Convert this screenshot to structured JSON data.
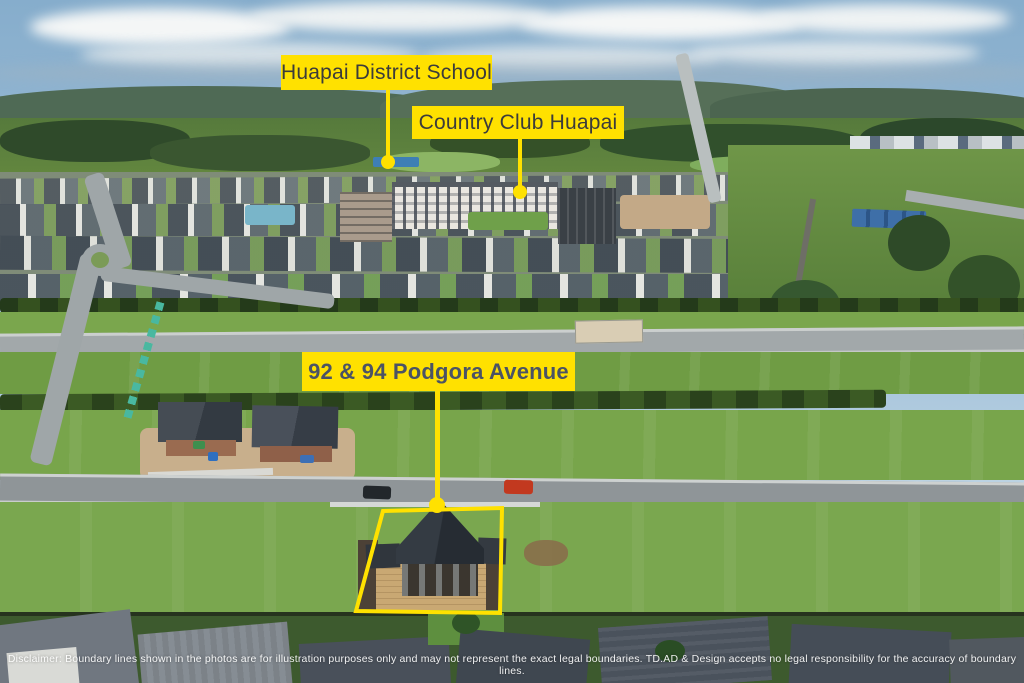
{
  "photo": {
    "description": "Aerial drone photograph of the Huapai subdivision with marketing callouts",
    "colors": {
      "label_background": "#FFE100",
      "label_text": "#3C3C3B",
      "address_label_text": "#4B5365",
      "leader_line": "#FFE100",
      "boundary_outline": "#FFE100",
      "disclaimer_text": "#FFFFFF"
    }
  },
  "callouts": {
    "school": {
      "label": "Huapai District School"
    },
    "country_club": {
      "label": "Country Club Huapai"
    },
    "address": {
      "label": "92 & 94 Podgora Avenue"
    }
  },
  "disclaimer": {
    "text": "Disclaimer: Boundary lines shown in the photos are for illustration purposes only and may not represent the exact legal boundaries. TD.AD & Design accepts no legal responsibility for the accuracy of boundary lines."
  }
}
